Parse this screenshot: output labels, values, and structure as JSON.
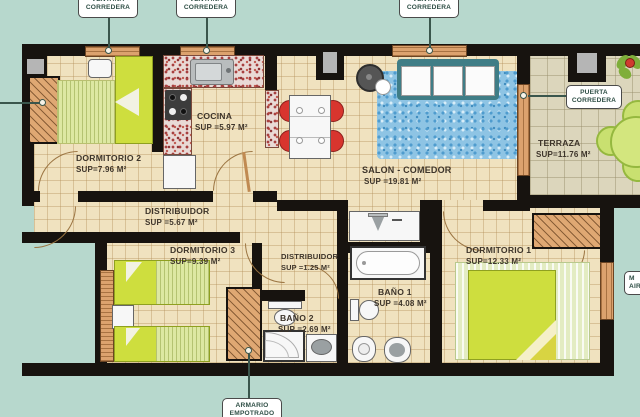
{
  "callouts": {
    "ventana1": {
      "line1": "VENTANA",
      "line2": "CORREDERA"
    },
    "ventana2": {
      "line1": "VENTANA",
      "line2": "CORREDERA"
    },
    "ventana3": {
      "line1": "VENTANA",
      "line2": "CORREDERA"
    },
    "puerta": {
      "line1": "PUERTA",
      "line2": "CORREDERA"
    },
    "armario": {
      "line1": "ARMARIO",
      "line2": "EMPOTRADO"
    },
    "ac_truncated": {
      "line1": "M",
      "line2": "AIR"
    }
  },
  "rooms": {
    "dormitorio2": {
      "name": "DORMITORIO 2",
      "area": "SUP=7.96 M²"
    },
    "cocina": {
      "name": "COCINA",
      "area": "SUP =5.97 M²"
    },
    "salon_comedor": {
      "name": "SALON - COMEDOR",
      "area": "SUP =19.81 M²"
    },
    "terraza": {
      "name": "TERRAZA",
      "area": "SUP=11.76 M²"
    },
    "distribuidor": {
      "name": "DISTRIBUIDOR",
      "area": "SUP =5.67 M²"
    },
    "dormitorio3": {
      "name": "DORMITORIO 3",
      "area": "SUP=9.39 M²"
    },
    "distribuidor2": {
      "name": "DISTRIBUIDOR",
      "area": "SUP =1.25 M²"
    },
    "bano1": {
      "name": "BAÑO 1",
      "area": "SUP =4.08 M²"
    },
    "bano2": {
      "name": "BAÑO 2",
      "area": "SUP =2.69 M²"
    },
    "dormitorio1": {
      "name": "DORMITORIO 1",
      "area": "SUP=12.33 M²"
    }
  },
  "colors": {
    "exterior": "#b7d8cd",
    "floor_tile": "#f0e2bf",
    "terrace_tile": "#dcd6bc",
    "wall": "#17130f",
    "wood": "#dca26e",
    "bed_green": "#cede3e",
    "rug_blue": "#8ec4e4",
    "chair_red": "#d8352e",
    "counter_speckle": "#a84040",
    "pillar_gray": "#b5b5b5",
    "plant_green": "#c9e070",
    "flower_red": "#d03a30",
    "label_text": "#2f4f46",
    "room_text": "#3d342a"
  }
}
